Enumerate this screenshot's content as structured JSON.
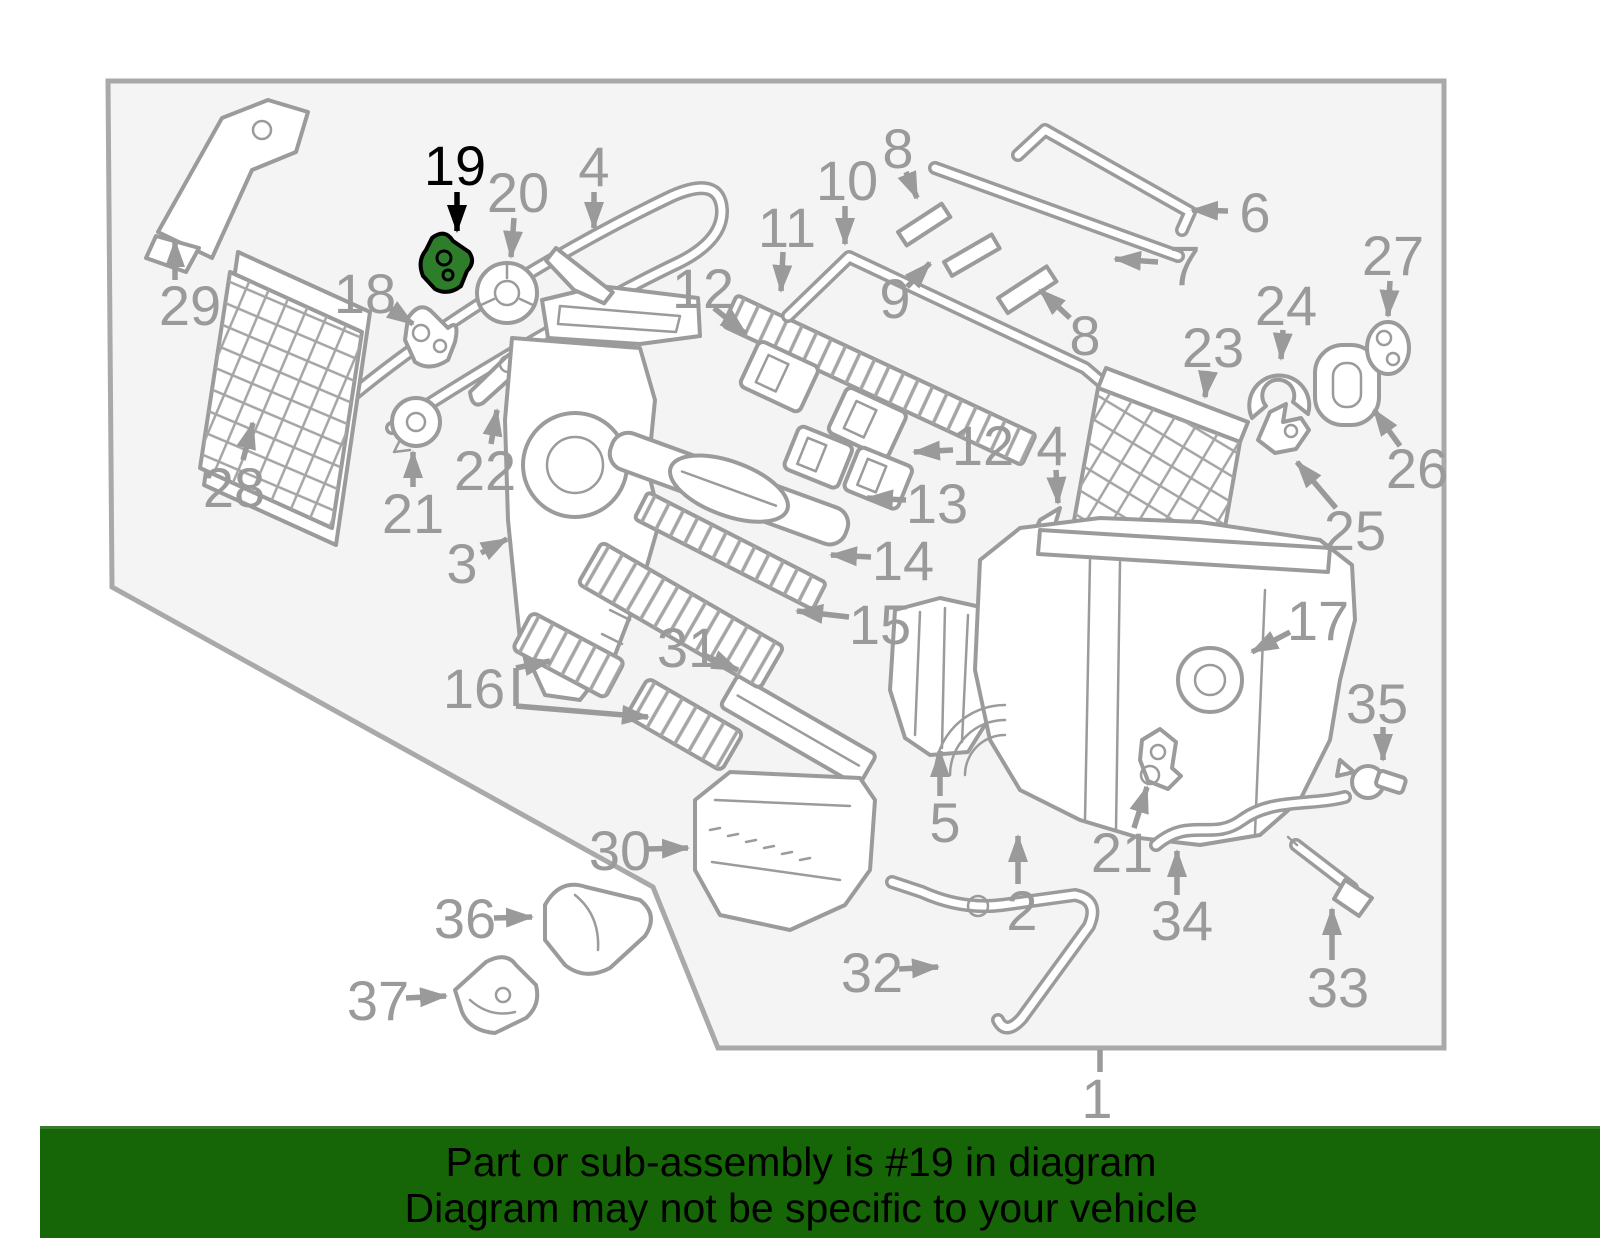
{
  "banner": {
    "line1": "Part or sub-assembly is #19 in diagram",
    "line2": "Diagram may not be specific to your vehicle"
  },
  "diagram": {
    "highlighted_part": "19",
    "colors": {
      "panel_bg": "#f4f4f4",
      "panel_border": "#a9a9a9",
      "line": "#9b9b9b",
      "label": "#9a9a9a",
      "highlight": "#000000",
      "highlight_part_fill": "#2e7d2b",
      "banner_bg": "#166607",
      "banner_text": "#000000"
    },
    "labels": [
      {
        "text": "29",
        "x": 190,
        "y": 305,
        "arrows": [
          {
            "x1": 175,
            "y1": 280,
            "x2": 175,
            "y2": 241
          }
        ]
      },
      {
        "text": "28",
        "x": 234,
        "y": 487,
        "arrows": [
          {
            "x1": 243,
            "y1": 460,
            "x2": 253,
            "y2": 423
          }
        ]
      },
      {
        "text": "18",
        "x": 365,
        "y": 293,
        "arrows": [
          {
            "x1": 388,
            "y1": 307,
            "x2": 413,
            "y2": 324
          }
        ]
      },
      {
        "text": "19",
        "x": 455,
        "y": 165,
        "highlight": true,
        "arrows": [
          {
            "x1": 457,
            "y1": 192,
            "x2": 457,
            "y2": 231
          }
        ]
      },
      {
        "text": "20",
        "x": 518,
        "y": 192,
        "arrows": [
          {
            "x1": 514,
            "y1": 218,
            "x2": 511,
            "y2": 257
          }
        ]
      },
      {
        "text": "4",
        "x": 594,
        "y": 166,
        "arrows": [
          {
            "x1": 594,
            "y1": 192,
            "x2": 594,
            "y2": 228
          }
        ]
      },
      {
        "text": "21",
        "x": 413,
        "y": 513,
        "arrows": [
          {
            "x1": 413,
            "y1": 487,
            "x2": 413,
            "y2": 452
          }
        ]
      },
      {
        "text": "22",
        "x": 485,
        "y": 470,
        "arrows": [
          {
            "x1": 491,
            "y1": 444,
            "x2": 497,
            "y2": 410
          }
        ]
      },
      {
        "text": "3",
        "x": 462,
        "y": 563,
        "arrows": [
          {
            "x1": 481,
            "y1": 553,
            "x2": 507,
            "y2": 539
          }
        ]
      },
      {
        "text": "16",
        "x": 474,
        "y": 688,
        "lines": [
          [
            516,
            668,
            516,
            706
          ]
        ],
        "arrows": [
          {
            "x1": 516,
            "y1": 668,
            "x2": 550,
            "y2": 661
          },
          {
            "x1": 516,
            "y1": 706,
            "x2": 648,
            "y2": 717
          }
        ]
      },
      {
        "text": "31",
        "x": 688,
        "y": 647,
        "arrows": [
          {
            "x1": 706,
            "y1": 656,
            "x2": 738,
            "y2": 670
          }
        ]
      },
      {
        "text": "30",
        "x": 620,
        "y": 850,
        "arrows": [
          {
            "x1": 647,
            "y1": 849,
            "x2": 688,
            "y2": 848
          }
        ]
      },
      {
        "text": "36",
        "x": 465,
        "y": 918,
        "arrows": [
          {
            "x1": 494,
            "y1": 918,
            "x2": 532,
            "y2": 917
          }
        ]
      },
      {
        "text": "37",
        "x": 378,
        "y": 1000,
        "arrows": [
          {
            "x1": 406,
            "y1": 998,
            "x2": 446,
            "y2": 996
          }
        ]
      },
      {
        "text": "32",
        "x": 872,
        "y": 972,
        "arrows": [
          {
            "x1": 899,
            "y1": 969,
            "x2": 938,
            "y2": 967
          }
        ]
      },
      {
        "text": "10",
        "x": 847,
        "y": 180,
        "arrows": [
          {
            "x1": 845,
            "y1": 206,
            "x2": 845,
            "y2": 244
          }
        ]
      },
      {
        "text": "8",
        "x": 898,
        "y": 148,
        "arrows": [
          {
            "x1": 906,
            "y1": 172,
            "x2": 917,
            "y2": 198
          }
        ]
      },
      {
        "text": "11",
        "x": 787,
        "y": 227,
        "arrows": [
          {
            "x1": 783,
            "y1": 252,
            "x2": 781,
            "y2": 291
          }
        ]
      },
      {
        "text": "12",
        "x": 703,
        "y": 288,
        "arrows": [
          {
            "x1": 714,
            "y1": 308,
            "x2": 746,
            "y2": 334
          }
        ]
      },
      {
        "text": "9",
        "x": 895,
        "y": 298,
        "arrows": [
          {
            "x1": 907,
            "y1": 287,
            "x2": 930,
            "y2": 263
          }
        ]
      },
      {
        "text": "8",
        "x": 1085,
        "y": 335,
        "arrows": [
          {
            "x1": 1070,
            "y1": 318,
            "x2": 1040,
            "y2": 290
          }
        ]
      },
      {
        "text": "7",
        "x": 1185,
        "y": 265,
        "arrows": [
          {
            "x1": 1158,
            "y1": 262,
            "x2": 1115,
            "y2": 259
          }
        ]
      },
      {
        "text": "6",
        "x": 1255,
        "y": 212,
        "arrows": [
          {
            "x1": 1228,
            "y1": 211,
            "x2": 1192,
            "y2": 210
          }
        ]
      },
      {
        "text": "27",
        "x": 1393,
        "y": 255,
        "arrows": [
          {
            "x1": 1390,
            "y1": 281,
            "x2": 1388,
            "y2": 316
          }
        ]
      },
      {
        "text": "24",
        "x": 1286,
        "y": 305,
        "arrows": [
          {
            "x1": 1283,
            "y1": 330,
            "x2": 1281,
            "y2": 359
          }
        ]
      },
      {
        "text": "23",
        "x": 1213,
        "y": 347,
        "arrows": [
          {
            "x1": 1208,
            "y1": 371,
            "x2": 1205,
            "y2": 397
          }
        ]
      },
      {
        "text": "26",
        "x": 1417,
        "y": 468,
        "arrows": [
          {
            "x1": 1400,
            "y1": 446,
            "x2": 1374,
            "y2": 410
          }
        ]
      },
      {
        "text": "25",
        "x": 1355,
        "y": 530,
        "arrows": [
          {
            "x1": 1336,
            "y1": 508,
            "x2": 1297,
            "y2": 462
          }
        ]
      },
      {
        "text": "12",
        "x": 983,
        "y": 445,
        "arrows": [
          {
            "x1": 953,
            "y1": 450,
            "x2": 914,
            "y2": 452
          }
        ]
      },
      {
        "text": "13",
        "x": 937,
        "y": 503,
        "arrows": [
          {
            "x1": 906,
            "y1": 500,
            "x2": 867,
            "y2": 498
          }
        ]
      },
      {
        "text": "14",
        "x": 903,
        "y": 560,
        "arrows": [
          {
            "x1": 871,
            "y1": 557,
            "x2": 831,
            "y2": 555
          }
        ]
      },
      {
        "text": "15",
        "x": 880,
        "y": 624,
        "arrows": [
          {
            "x1": 849,
            "y1": 617,
            "x2": 797,
            "y2": 611
          }
        ]
      },
      {
        "text": "4",
        "x": 1052,
        "y": 445,
        "arrows": [
          {
            "x1": 1056,
            "y1": 470,
            "x2": 1058,
            "y2": 503
          }
        ]
      },
      {
        "text": "17",
        "x": 1318,
        "y": 620,
        "arrows": [
          {
            "x1": 1290,
            "y1": 632,
            "x2": 1252,
            "y2": 652
          }
        ]
      },
      {
        "text": "35",
        "x": 1377,
        "y": 703,
        "arrows": [
          {
            "x1": 1383,
            "y1": 727,
            "x2": 1383,
            "y2": 760
          }
        ]
      },
      {
        "text": "5",
        "x": 945,
        "y": 822,
        "arrows": [
          {
            "x1": 940,
            "y1": 796,
            "x2": 940,
            "y2": 751
          }
        ]
      },
      {
        "text": "2",
        "x": 1022,
        "y": 910,
        "arrows": [
          {
            "x1": 1018,
            "y1": 884,
            "x2": 1018,
            "y2": 836
          }
        ]
      },
      {
        "text": "21",
        "x": 1122,
        "y": 852,
        "arrows": [
          {
            "x1": 1134,
            "y1": 828,
            "x2": 1147,
            "y2": 787
          }
        ]
      },
      {
        "text": "34",
        "x": 1182,
        "y": 920,
        "arrows": [
          {
            "x1": 1177,
            "y1": 895,
            "x2": 1177,
            "y2": 851
          }
        ]
      },
      {
        "text": "33",
        "x": 1338,
        "y": 987,
        "arrows": [
          {
            "x1": 1332,
            "y1": 960,
            "x2": 1332,
            "y2": 909
          }
        ]
      },
      {
        "text": "1",
        "x": 1097,
        "y": 1098,
        "lines": [
          [
            1100,
            1050,
            1100,
            1072
          ]
        ]
      }
    ]
  }
}
